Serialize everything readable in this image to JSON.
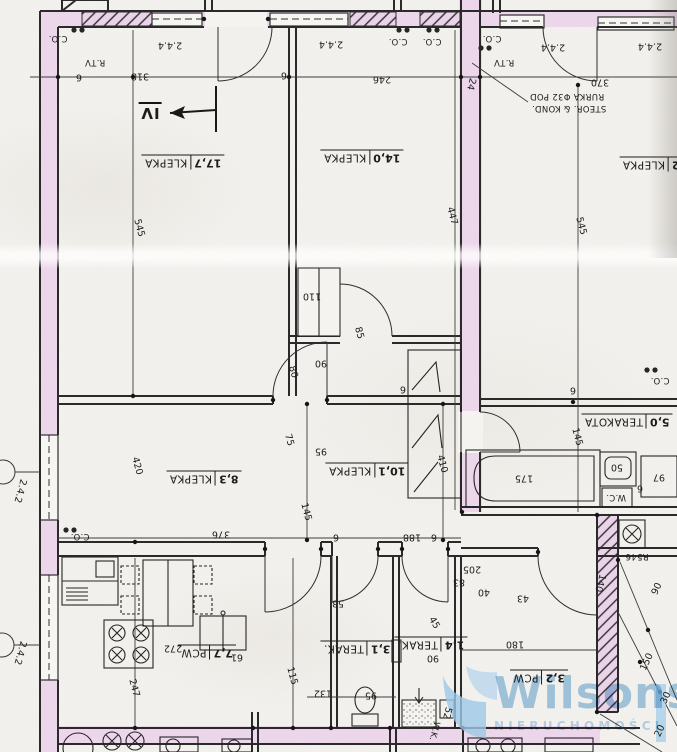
{
  "document": {
    "kind": "scanned apartment floor plan, rotated 180°"
  },
  "colors": {
    "wall_highlight_pink": "#eed7ec",
    "ink": "#262626",
    "paper": "#f4f2ee",
    "watermark_blue": "#a6cde9"
  },
  "watermark": {
    "brand": "Wilsons",
    "tagline": "NIERUCHOMOŚCI"
  },
  "plan": {
    "rooms": [
      {
        "area": "17,7",
        "floor": "KLEPKA",
        "x": 183,
        "y": 162
      },
      {
        "area": "14,0",
        "floor": "KLEPKA",
        "x": 362,
        "y": 157
      },
      {
        "area": "2",
        "floor": "KLEPKA",
        "x": 651,
        "y": 164
      },
      {
        "area": "8,3",
        "floor": "KLEPKA",
        "x": 204,
        "y": 478
      },
      {
        "area": "10,1",
        "floor": "KLEPKA",
        "x": 367,
        "y": 470
      },
      {
        "area": "7,7",
        "floor": "PCW",
        "x": 207,
        "y": 652
      },
      {
        "area": "5,0",
        "floor": "TERAKOTA",
        "x": 627,
        "y": 421
      },
      {
        "area": "3,1",
        "floor": "TERAK.",
        "x": 357,
        "y": 648
      },
      {
        "area": "1,4",
        "floor": "TERAK.",
        "x": 431,
        "y": 644
      },
      {
        "area": "3,2",
        "floor": "PCW",
        "x": 539,
        "y": 677
      }
    ],
    "dims": [
      {
        "t": "318",
        "x": 140,
        "y": 76
      },
      {
        "t": "246",
        "x": 382,
        "y": 79
      },
      {
        "t": "370",
        "x": 600,
        "y": 82
      },
      {
        "t": "24",
        "x": 471,
        "y": 84,
        "r": 105
      },
      {
        "t": "545",
        "x": 139,
        "y": 228,
        "r": 75
      },
      {
        "t": "545",
        "x": 581,
        "y": 226,
        "r": 75
      },
      {
        "t": "447",
        "x": 452,
        "y": 216,
        "r": 75
      },
      {
        "t": "2.4.4",
        "x": 170,
        "y": 45
      },
      {
        "t": "2.4.4",
        "x": 331,
        "y": 44
      },
      {
        "t": "2.4.4",
        "x": 553,
        "y": 47
      },
      {
        "t": "2.4.4",
        "x": 650,
        "y": 46
      },
      {
        "t": "110",
        "x": 312,
        "y": 296
      },
      {
        "t": "90",
        "x": 321,
        "y": 363
      },
      {
        "t": "80",
        "x": 293,
        "y": 372,
        "r": 75
      },
      {
        "t": "85",
        "x": 359,
        "y": 333,
        "r": 75
      },
      {
        "t": "75",
        "x": 289,
        "y": 440,
        "r": 75
      },
      {
        "t": "95",
        "x": 321,
        "y": 451
      },
      {
        "t": "145",
        "x": 306,
        "y": 512,
        "r": 75
      },
      {
        "t": "145",
        "x": 577,
        "y": 437,
        "r": 75
      },
      {
        "t": "175",
        "x": 524,
        "y": 478
      },
      {
        "t": "50",
        "x": 617,
        "y": 467
      },
      {
        "t": "97",
        "x": 659,
        "y": 477
      },
      {
        "t": "420",
        "x": 137,
        "y": 466,
        "r": 75
      },
      {
        "t": "410",
        "x": 442,
        "y": 464,
        "r": 75
      },
      {
        "t": "376",
        "x": 221,
        "y": 534
      },
      {
        "t": "188",
        "x": 412,
        "y": 537
      },
      {
        "t": "2.4.2",
        "x": 20,
        "y": 491,
        "r": 105
      },
      {
        "t": "2.4.2",
        "x": 20,
        "y": 653,
        "r": 105
      },
      {
        "t": "247",
        "x": 134,
        "y": 688,
        "r": 75
      },
      {
        "t": "272",
        "x": 173,
        "y": 648
      },
      {
        "t": "115",
        "x": 292,
        "y": 676,
        "r": 75
      },
      {
        "t": "132",
        "x": 323,
        "y": 693
      },
      {
        "t": "95",
        "x": 371,
        "y": 695
      },
      {
        "t": "61",
        "x": 237,
        "y": 657
      },
      {
        "t": "52",
        "x": 447,
        "y": 713,
        "r": 105
      },
      {
        "t": "205",
        "x": 472,
        "y": 569
      },
      {
        "t": "83",
        "x": 459,
        "y": 582
      },
      {
        "t": "40",
        "x": 484,
        "y": 592
      },
      {
        "t": "43",
        "x": 523,
        "y": 598
      },
      {
        "t": "45",
        "x": 434,
        "y": 623,
        "r": 60
      },
      {
        "t": "53",
        "x": 338,
        "y": 603
      },
      {
        "t": "180",
        "x": 515,
        "y": 644
      },
      {
        "t": "140",
        "x": 600,
        "y": 583,
        "r": 105
      },
      {
        "t": "90",
        "x": 433,
        "y": 658
      },
      {
        "t": "90",
        "x": 657,
        "y": 589,
        "r": -65
      },
      {
        "t": "150",
        "x": 647,
        "y": 662,
        "r": -65
      },
      {
        "t": "30",
        "x": 666,
        "y": 698,
        "r": -65
      },
      {
        "t": "20",
        "x": 660,
        "y": 731,
        "r": -65
      },
      {
        "t": "6",
        "x": 79,
        "y": 77
      },
      {
        "t": "6",
        "x": 284,
        "y": 75
      },
      {
        "t": "6",
        "x": 403,
        "y": 389
      },
      {
        "t": "6",
        "x": 573,
        "y": 390
      },
      {
        "t": "6",
        "x": 640,
        "y": 488
      },
      {
        "t": "6",
        "x": 336,
        "y": 537
      },
      {
        "t": "6",
        "x": 434,
        "y": 537
      }
    ],
    "notes": [
      {
        "t": "C.O.",
        "x": 58,
        "y": 38,
        "n": "radiator-label"
      },
      {
        "t": "C.O.",
        "x": 398,
        "y": 41,
        "n": "radiator-label"
      },
      {
        "t": "C.O.",
        "x": 432,
        "y": 41,
        "n": "radiator-label"
      },
      {
        "t": "C.O.",
        "x": 492,
        "y": 38,
        "n": "radiator-label"
      },
      {
        "t": "C.O.",
        "x": 80,
        "y": 536,
        "n": "radiator-label"
      },
      {
        "t": "C.O.",
        "x": 660,
        "y": 380,
        "n": "radiator-label"
      },
      {
        "t": "R.TV",
        "x": 95,
        "y": 62,
        "n": "tv-outlet-label"
      },
      {
        "t": "R.TV",
        "x": 504,
        "y": 62,
        "n": "tv-outlet-label"
      },
      {
        "t": "RURKA Φ32 POD",
        "x": 567,
        "y": 96,
        "n": "pipe-note-line1"
      },
      {
        "t": "STEOR. & KOND.",
        "x": 569,
        "y": 108,
        "n": "pipe-note-line2"
      },
      {
        "t": "W.C.",
        "x": 616,
        "y": 497,
        "n": "wc-label"
      },
      {
        "t": "W.K.",
        "x": 434,
        "y": 731,
        "r": 105,
        "n": "wk-label"
      },
      {
        "t": "R546",
        "x": 637,
        "y": 556,
        "n": "riser-label"
      },
      {
        "t": "IV",
        "x": 150,
        "y": 112,
        "big": true,
        "n": "section-marker"
      }
    ]
  }
}
